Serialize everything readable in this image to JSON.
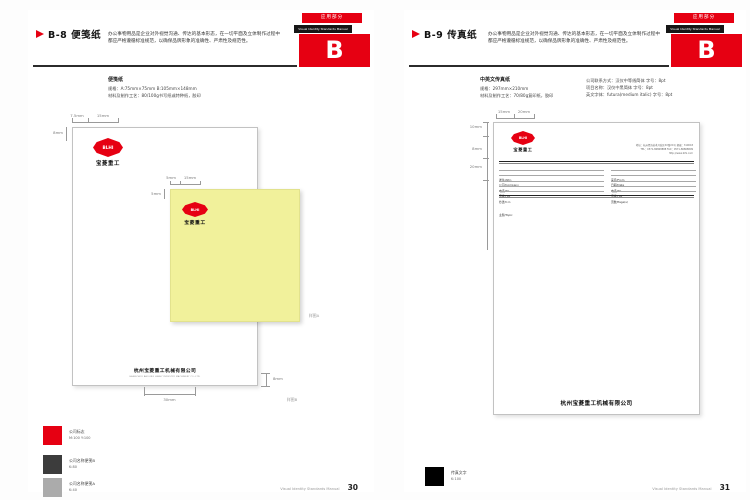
{
  "manual": {
    "tab_label": "应用部分",
    "name": "Visual Identity Standards Manual",
    "letter": "B",
    "footer_label": "Visual Identity Standards Manual",
    "accent_red": "#e60012",
    "note_yellow": "#f1f19b"
  },
  "logo": {
    "mark": "BLHI",
    "cn": "宝菱重工"
  },
  "company": {
    "cn": "杭州宝菱重工机械有限公司",
    "en": "HANGZHOU BAOLING HEAVY INDUSTRY MACHINERY CO.,LTD."
  },
  "left": {
    "title": "B-8 便笺纸",
    "description": "办公事物用品是企业对外视觉沟通、传达的基本形态，在一切平面及立体制作过程中都应严格遵循标准规范，以确保品牌形象的准确性、严肃性及规范性。",
    "spec_title": "便笺纸",
    "spec_line1": "规格：A:75mm×75mm  B:105mm×148mm",
    "spec_line2": "材料及制作工艺：80/100g书写纸或特种纸，胶印",
    "dims": {
      "top_a": "7.5mm",
      "top_b": "15mm",
      "left_a": "8mm",
      "note_top_a": "5mm",
      "note_top_b": "15mm",
      "note_left": "5mm",
      "bottom": "30mm",
      "bottom_right": "8mm"
    },
    "annotation_a": "样图A",
    "annotation_b": "样图B",
    "legend": [
      {
        "label": "公司标志",
        "value": "M:100 Y:100",
        "color": "#e60012"
      },
      {
        "label": "公司名称便笺B",
        "value": "K:80",
        "color": "#3c3c3c"
      },
      {
        "label": "公司名称便笺A",
        "value": "K:40",
        "color": "#ababab"
      }
    ],
    "page_number": "30"
  },
  "right": {
    "title": "B-9 传真纸",
    "description": "办公事物用品是企业对外视觉沟通、传达的基本形态，在一切平面及立体制作过程中都应严格遵循标准规范，以确保品牌形象的准确性、严肃性及规范性。",
    "spec_title": "中英文传真纸",
    "spec_line1": "规格：297mm×210mm",
    "spec_line2": "材料及制作工艺：70/80g复印纸，胶印",
    "type_line1": "公司联系方式：汉仪中等线简体 字号：8pt",
    "type_line2": "项目名称：汉仪中黑简体 字号：8pt",
    "type_line3": "英文字体：futura(medium italic) 字号：8pt",
    "dims": {
      "top_a": "15mm",
      "top_b": "20mm",
      "left_a": "10mm",
      "left_b": "8mm",
      "left_c": "20mm"
    },
    "fax": {
      "contact": [
        "地址：杭州经济技术开发区XX路XX号  邮编：310018",
        "TEL：0571-86868888  FAX：0571-86868899",
        "http://www.blhi.com"
      ],
      "left_fields": [
        "发往/Attn",
        "公司/Company",
        "电话/Tel",
        "传真/Fax",
        "抄送/C.C."
      ],
      "right_fields": [
        "来自/From",
        "日期/Date",
        "电话/Tel",
        "传真/Fax",
        "页数/Page(s)"
      ],
      "topic_label": "主题/Topic"
    },
    "legend": [
      {
        "label": "传真文字",
        "value": "K:100",
        "color": "#000000"
      }
    ],
    "page_number": "31"
  }
}
